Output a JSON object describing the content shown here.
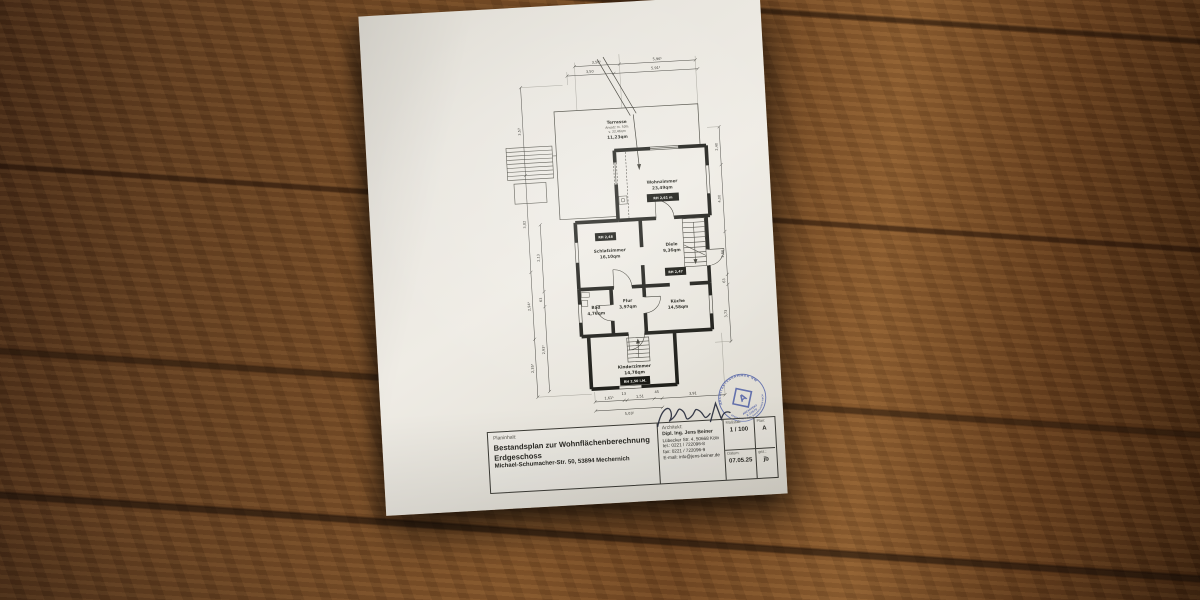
{
  "title_block": {
    "plan_content_label": "Planinhalt:",
    "title_line1": "Bestandsplan zur Wohnflächenberechnung",
    "title_line2": "Erdgeschoss",
    "address": "Michael-Schumacher-Str. 50, 53894 Mechernich",
    "architect_label": "Architekt:",
    "architect_name": "Dipl. Ing. Jens Beiner",
    "architect_address": "Lübecker Str. 4, 50668 Köln",
    "architect_tel": "tel.: 0221 / 722096-8",
    "architect_fax": "fax: 0221 / 722096-9",
    "architect_email": "E-mail: info@jens-beiner.de",
    "scale_label": "Maßstab:",
    "scale_value": "1 / 100",
    "plan_label": "Plan:",
    "plan_value": "A",
    "date_label": "Datum:",
    "date_value": "07.05.25",
    "drawn_label": "gez.:",
    "drawn_value": "jb"
  },
  "rooms": {
    "terrasse": {
      "name": "Terrasse",
      "note1": "Ansatz m. 50%",
      "note2": "v. 22,46qm",
      "area": "11,23qm"
    },
    "wohnzimmer": {
      "name": "Wohnzimmer",
      "area": "23,49qm",
      "height_badge": "RH 2,61 m"
    },
    "schlafzimmer": {
      "name": "Schlafzimmer",
      "area": "16,10qm",
      "height_badge": "RH 2,48"
    },
    "diele": {
      "name": "Diele",
      "area": "9,36qm"
    },
    "bad": {
      "name": "Bad",
      "area": "4,76qm"
    },
    "flur": {
      "name": "Flur",
      "area": "3,97qm"
    },
    "kueche": {
      "name": "Küche",
      "area": "14,58qm",
      "height_badge": "RH 2,47"
    },
    "kinderzimmer": {
      "name": "Kinderzimmer",
      "area": "14,78qm",
      "height_badge": "RH 2,50 i.M."
    }
  },
  "dimensions": {
    "top_outer": [
      "3,50⁵",
      "5,96⁵"
    ],
    "top_inner": [
      "3,50",
      "5,91⁵"
    ],
    "left_outer": [
      "3,57",
      "3,82",
      "2,94⁵",
      "2,35⁵"
    ],
    "left_inner": [
      "2,13",
      "63",
      "2,93⁵"
    ],
    "right": [
      "2,40",
      "4,00",
      "2,66",
      "63",
      "3,73"
    ],
    "bottom": [
      "1,61⁵",
      "13",
      "1,51",
      "45",
      "3,91"
    ],
    "bottom_total": "5,03⁵"
  },
  "stamp": {
    "ring_top": "ARCHITEKTENKAMMER NW",
    "ring_bottom": "KÖRPERSCHAFT DES ÖFFENTLICHEN RECHTS",
    "logo_letter": "A",
    "line1": "ARCHITEKT",
    "line2": "A 23570"
  }
}
